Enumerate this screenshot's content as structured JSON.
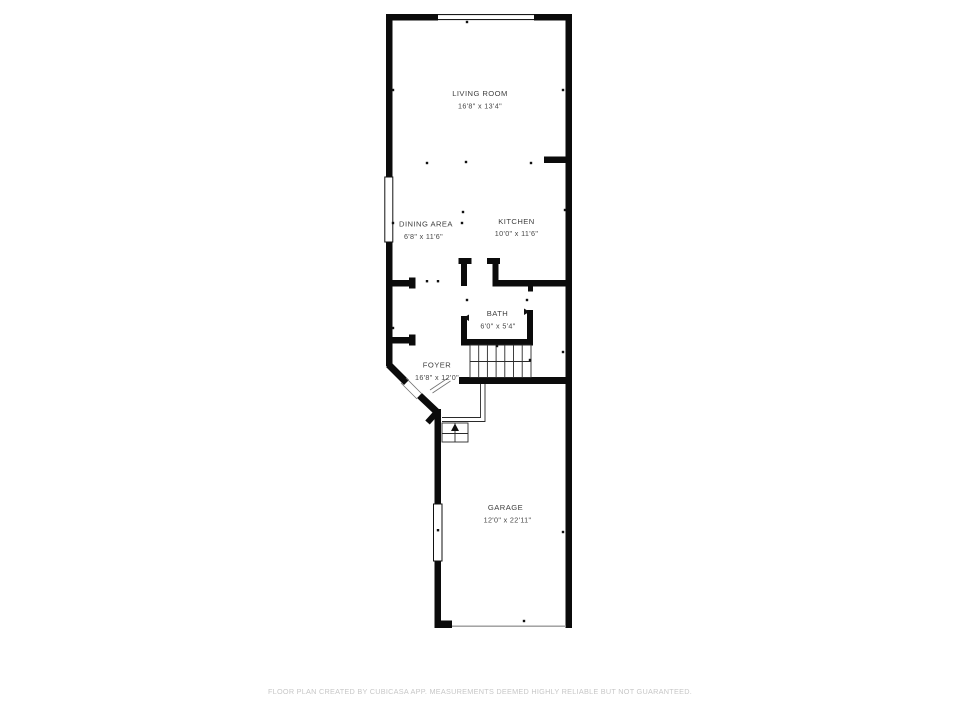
{
  "floor_plan": {
    "rooms": [
      {
        "name": "LIVING ROOM",
        "dimensions": "16'8\" x 13'4\""
      },
      {
        "name": "DINING AREA",
        "dimensions": "6'8\" x 11'6\""
      },
      {
        "name": "KITCHEN",
        "dimensions": "10'0\" x 11'6\""
      },
      {
        "name": "BATH",
        "dimensions": "6'0\" x 5'4\""
      },
      {
        "name": "FOYER",
        "dimensions": "16'8\" x 12'0\""
      },
      {
        "name": "GARAGE",
        "dimensions": "12'0\" x 22'11\""
      }
    ],
    "colors": {
      "wall": "#0b0b0b",
      "room_label": "#3e3e3e",
      "disclaimer_text": "#c7c7c7",
      "background": "#ffffff"
    }
  },
  "footer": {
    "disclaimer": "FLOOR PLAN CREATED BY CUBICASA APP. MEASUREMENTS DEEMED HIGHLY RELIABLE BUT NOT GUARANTEED."
  }
}
